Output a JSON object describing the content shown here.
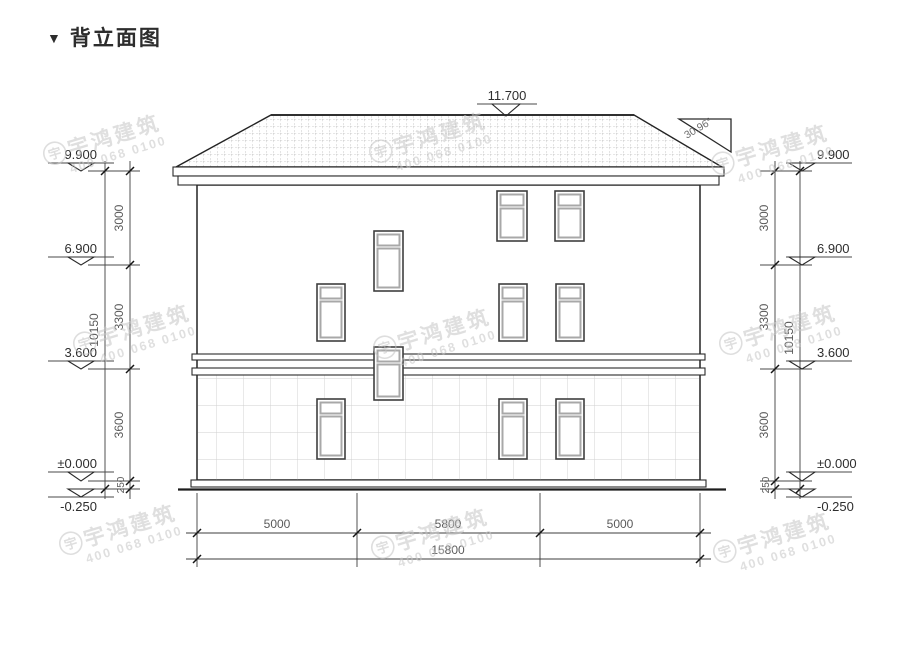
{
  "title": {
    "marker": "▼",
    "text": "背立面图"
  },
  "watermark": {
    "logo_glyph": "宇",
    "brand": "宇鸿建筑",
    "phone": "400 068 0100"
  },
  "annotations": {
    "ridge_elevation": "11.700",
    "roof_slope_angle": "30.96°"
  },
  "levels": [
    {
      "label": "9.900"
    },
    {
      "label": "6.900"
    },
    {
      "label": "3.600"
    },
    {
      "label": "±0.000"
    },
    {
      "label": "-0.250"
    }
  ],
  "vertical_dims": {
    "segments": [
      {
        "value": "3000"
      },
      {
        "value": "3300"
      },
      {
        "value": "3600"
      },
      {
        "value": "250"
      }
    ],
    "total": "10150"
  },
  "horizontal_dims": {
    "segments": [
      {
        "value": "5000"
      },
      {
        "value": "5800"
      },
      {
        "value": "5000"
      }
    ],
    "total": "15800"
  }
}
